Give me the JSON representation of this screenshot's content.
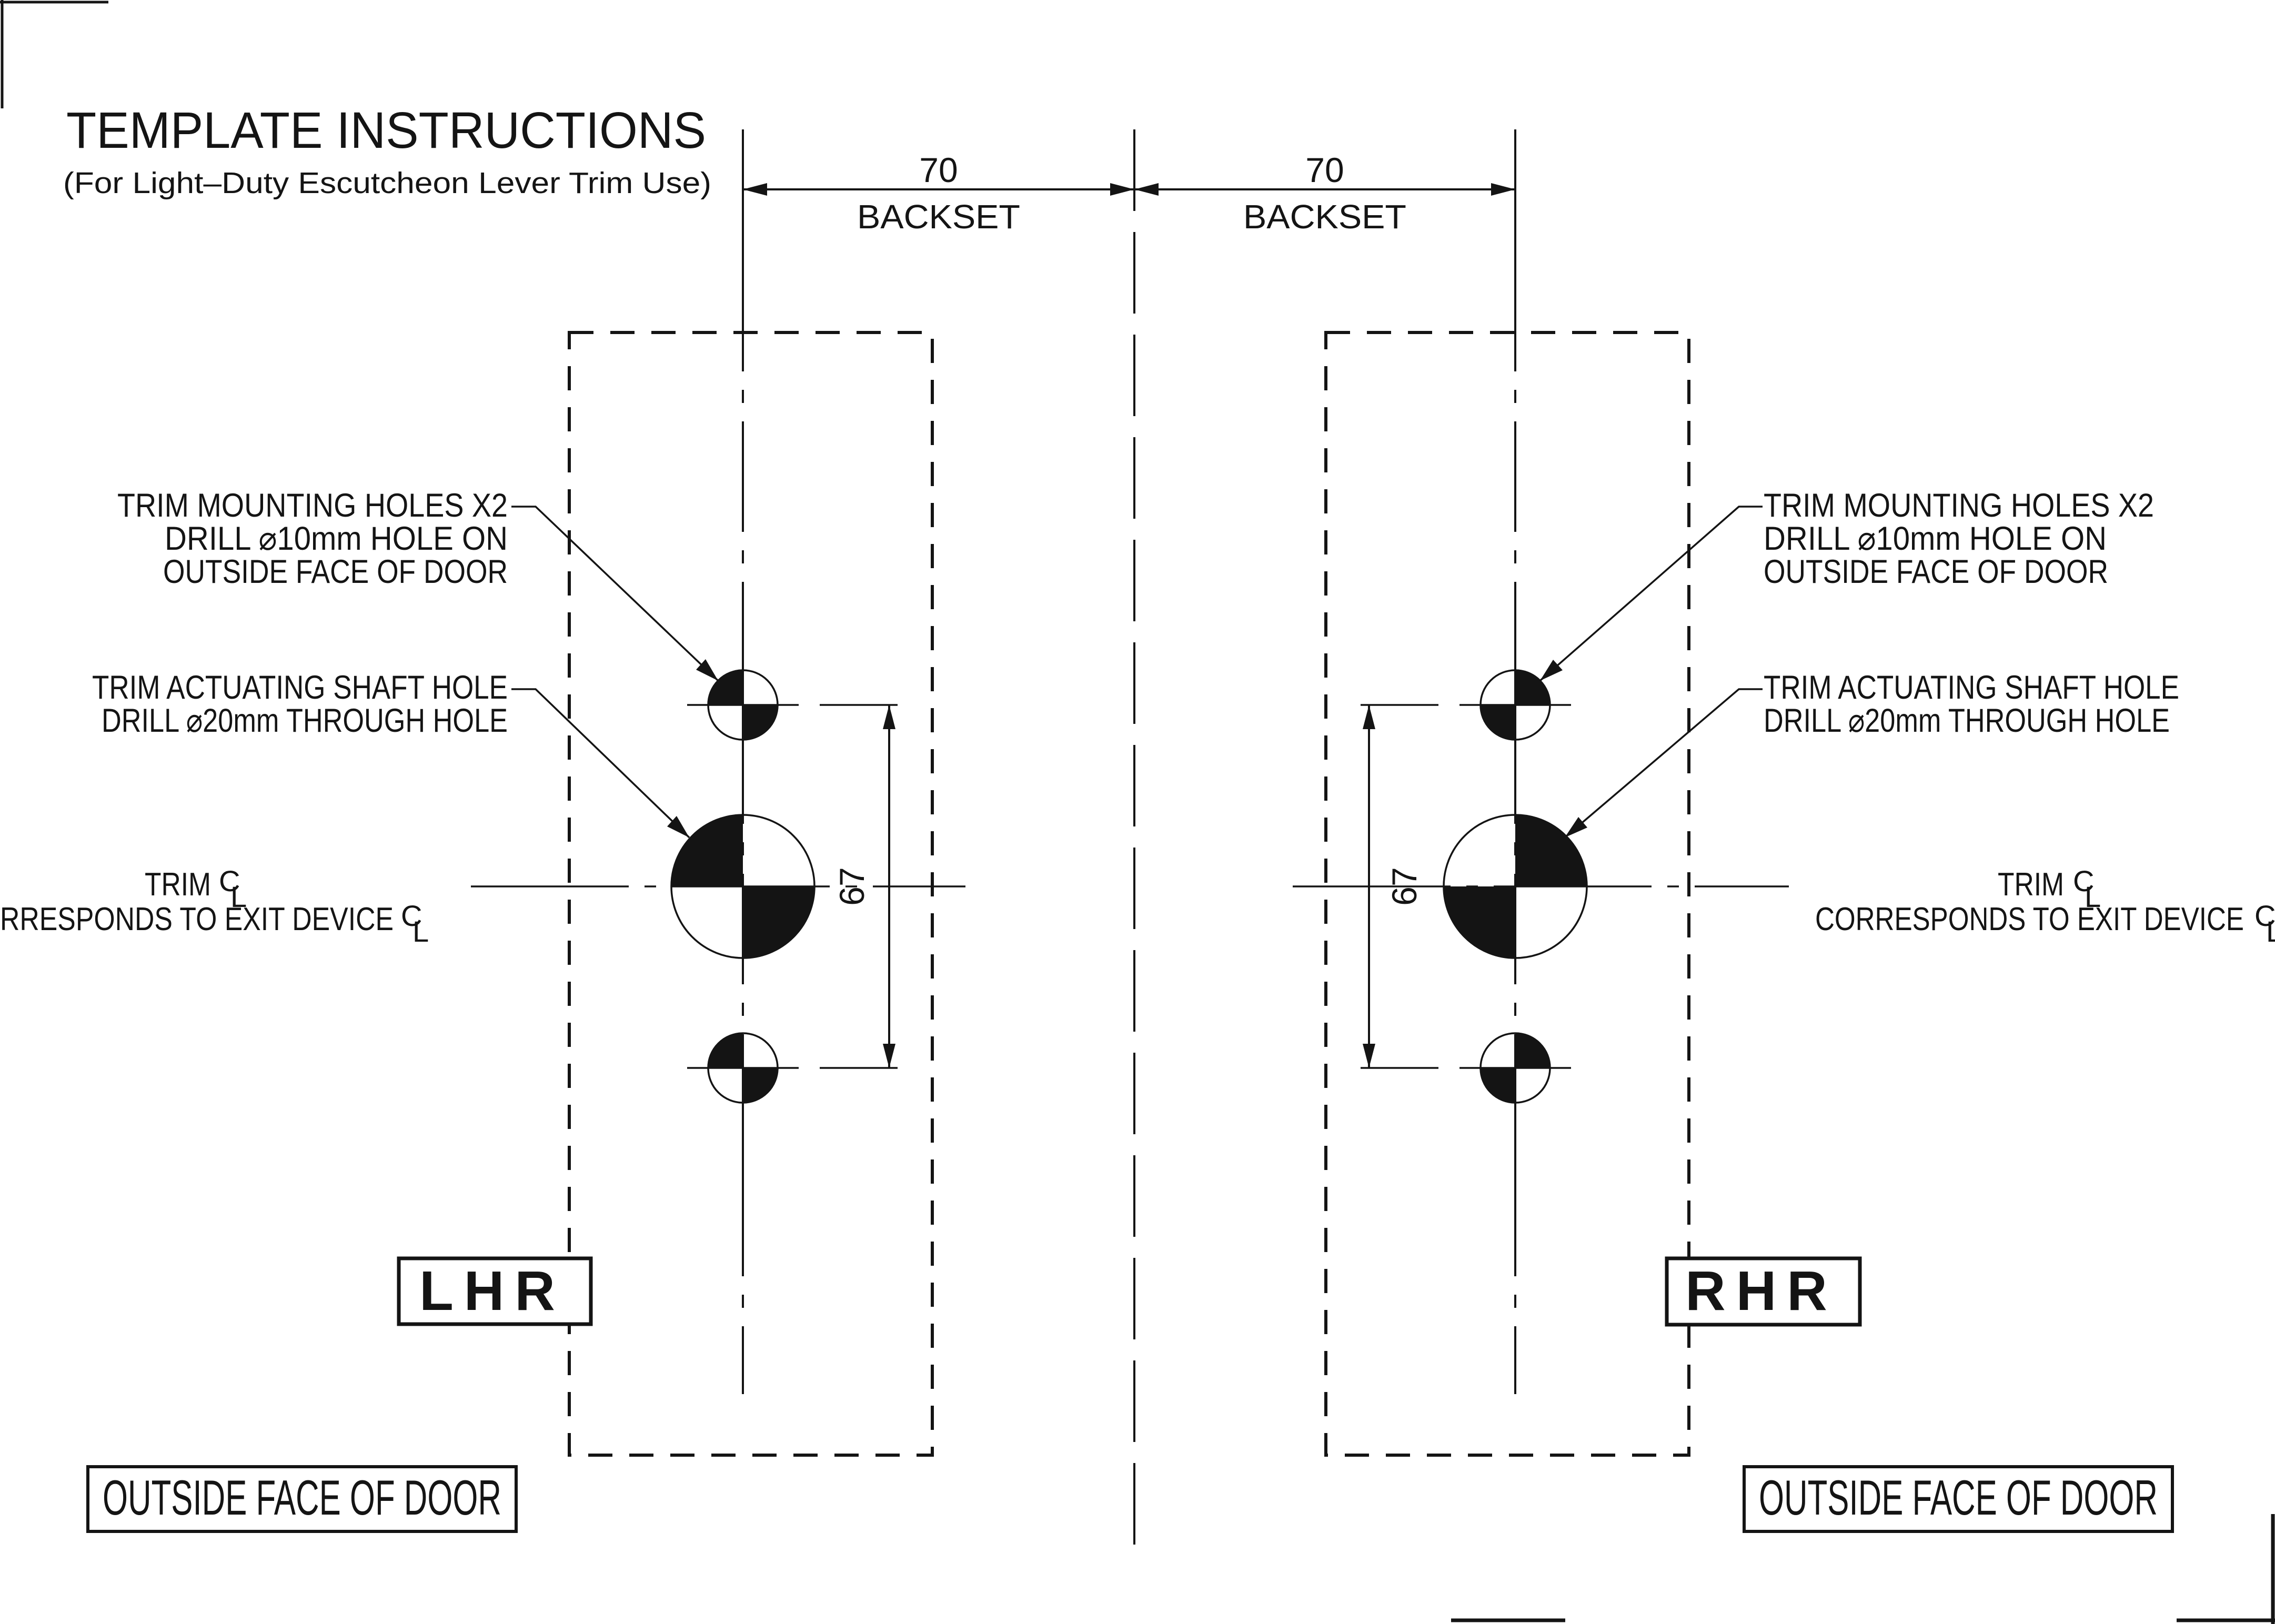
{
  "title": "TEMPLATE INSTRUCTIONS",
  "subtitle": "(For Light–Duty Escutcheon Lever Trim Use)",
  "dimensions": {
    "backset_value": "70",
    "backset_label": "BACKSET",
    "hole_spacing_value": "67"
  },
  "labels": {
    "mounting_line1": "TRIM MOUNTING HOLES X2",
    "mounting_line2": "DRILL ⌀10mm HOLE ON",
    "mounting_line3": "OUTSIDE FACE OF DOOR",
    "actuating_line1": "TRIM ACTUATING SHAFT HOLE",
    "actuating_line2": "DRILL ⌀20mm THROUGH HOLE",
    "trim_cl_word": "TRIM",
    "trim_cl_left_line2": "RRESPONDS TO EXIT DEVICE",
    "trim_cl_right_line2": "CORRESPONDS TO EXIT DEVICE",
    "centerline_symbol_c": "C",
    "centerline_symbol_l": "L"
  },
  "handing": {
    "left": "LHR",
    "right": "RHR"
  },
  "footer": {
    "outside_face": "OUTSIDE FACE OF DOOR"
  },
  "colors": {
    "ink": "#141414",
    "background": "#ffffff"
  }
}
